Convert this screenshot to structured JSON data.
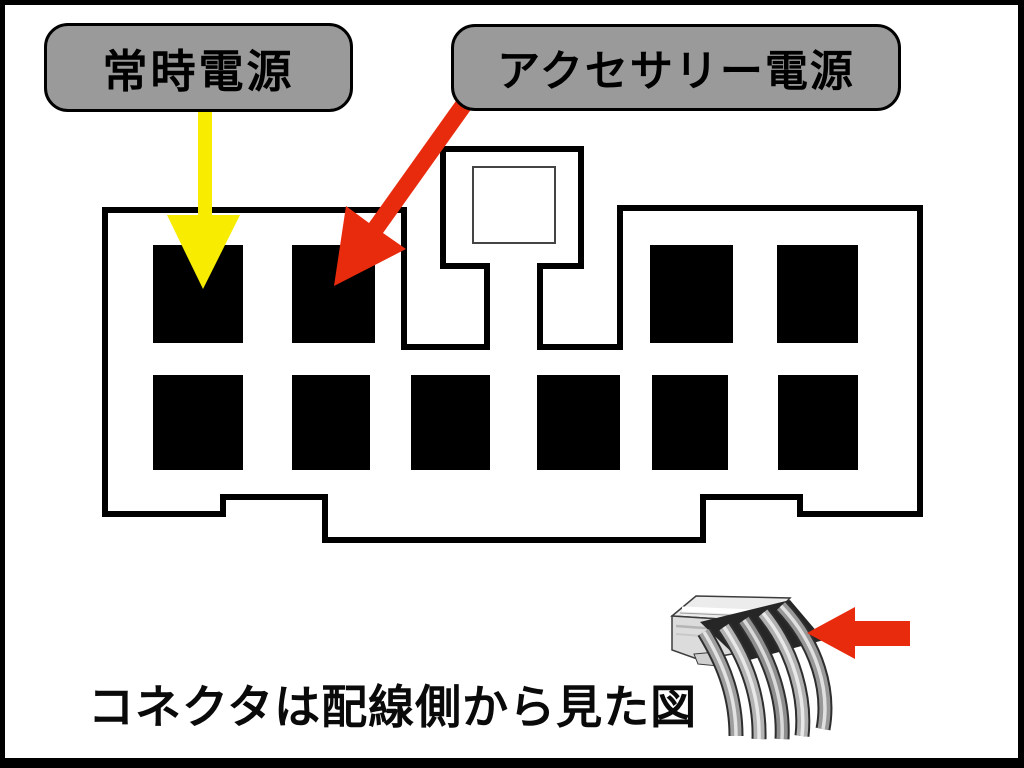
{
  "labels": {
    "constant_power": {
      "text": "常時電源"
    },
    "accessory_power": {
      "text": "アクセサリー電源"
    }
  },
  "caption": {
    "text": "コネクタは配線側から見た図"
  },
  "colors": {
    "label_fill": "#9a9a9a",
    "label_border": "#000000",
    "caption_color": "#0a0a0a",
    "arrow_yellow": "#f8ec00",
    "arrow_red": "#e92b0d",
    "pin_fill": "#000000",
    "outline": "#000000",
    "latch_window_stroke": "#444444"
  },
  "connector": {
    "outline_path": "M105,210 H404 V347 H487 V266 H443 V149 H581 V266 H540 V347 H620 V208 H920 V514 H800 V497 H703 V540 H325 V497 H223 V514 H105 Z",
    "latch_window": {
      "x": 473,
      "y": 167,
      "width": 82,
      "height": 76
    },
    "pins_top": [
      {
        "x": 153,
        "y": 245,
        "w": 90,
        "h": 98
      },
      {
        "x": 292,
        "y": 245,
        "w": 83,
        "h": 98
      },
      {
        "x": 650,
        "y": 245,
        "w": 83,
        "h": 98
      },
      {
        "x": 777,
        "y": 245,
        "w": 81,
        "h": 98
      }
    ],
    "pins_bottom": [
      {
        "x": 153,
        "y": 375,
        "w": 90,
        "h": 95
      },
      {
        "x": 292,
        "y": 375,
        "w": 78,
        "h": 95
      },
      {
        "x": 411,
        "y": 375,
        "w": 79,
        "h": 95
      },
      {
        "x": 537,
        "y": 375,
        "w": 83,
        "h": 95
      },
      {
        "x": 652,
        "y": 375,
        "w": 76,
        "h": 95
      },
      {
        "x": 778,
        "y": 375,
        "w": 80,
        "h": 95
      }
    ]
  },
  "arrows": {
    "constant_power_pointer": {
      "points": "198,108 212,108 212,215 240,215 203,289 167,215 198,215"
    },
    "accessory_power_pointer": {
      "points": "463,91 369,223 346,206 334,286 406,249 383,233 477,101"
    },
    "photo_pointer": {
      "points": "807,633 855,607 855,621 910,621 910,646 855,646 855,659"
    }
  }
}
